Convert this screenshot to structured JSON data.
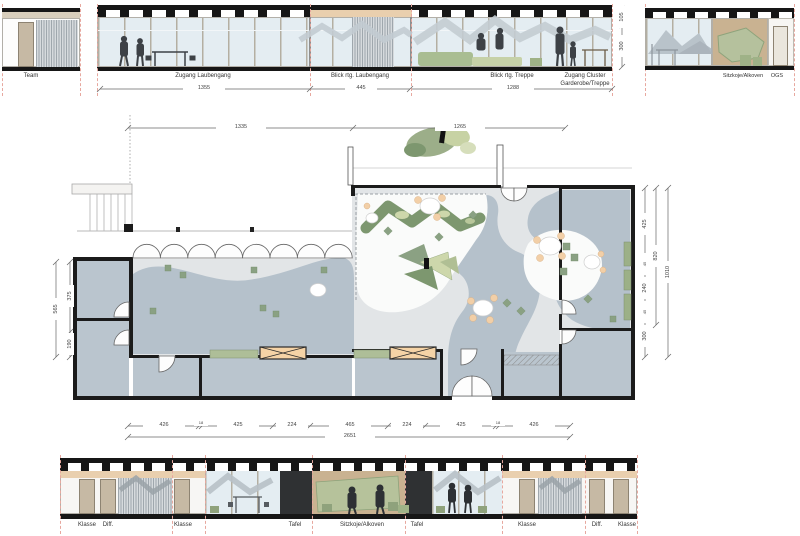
{
  "sheet_title": "Cluster floor plan with elevations",
  "top_row": {
    "team_label": "Team",
    "sections": [
      "Zugang Laubengang",
      "Blick rtg. Laubengang",
      "Blick rtg. Treppe"
    ],
    "cluster_line1": "Zugang Cluster",
    "cluster_line2": "Garderobe/Treppe",
    "right_labels": [
      "Sitzkoje/Alkoven",
      "OGS"
    ],
    "dims": [
      "1355",
      "445",
      "1288"
    ],
    "vdims": [
      "105",
      "300"
    ]
  },
  "plan": {
    "top_dims": [
      "1335",
      "1265"
    ],
    "bottom_dims": {
      "segments": [
        "426",
        "18",
        "425",
        "224",
        "465",
        "224",
        "425",
        "18",
        "426"
      ],
      "total": "2651"
    },
    "left_dims": {
      "segments": [
        "375",
        "190"
      ],
      "total": "565"
    },
    "right_dims": {
      "segments": [
        "425",
        "45",
        "240",
        "45",
        "300"
      ],
      "middle": "820",
      "total": "1010"
    }
  },
  "bottom_row": {
    "labels": [
      "Klasse",
      "Diff.",
      "Klasse",
      "Tafel",
      "Sitzkoje/Alkoven",
      "Tafel",
      "Klasse",
      "Diff.",
      "Klasse"
    ]
  },
  "colors": {
    "room_fill": "#bac5ce",
    "landscape_fill": "#b5c1cb",
    "green_dark": "#7d976f",
    "green_light": "#cdd7ab",
    "peach": "#f2cfa7",
    "wood": "#c9b291",
    "glass": "#e4edf2",
    "section_cut": "#e7a89f"
  }
}
